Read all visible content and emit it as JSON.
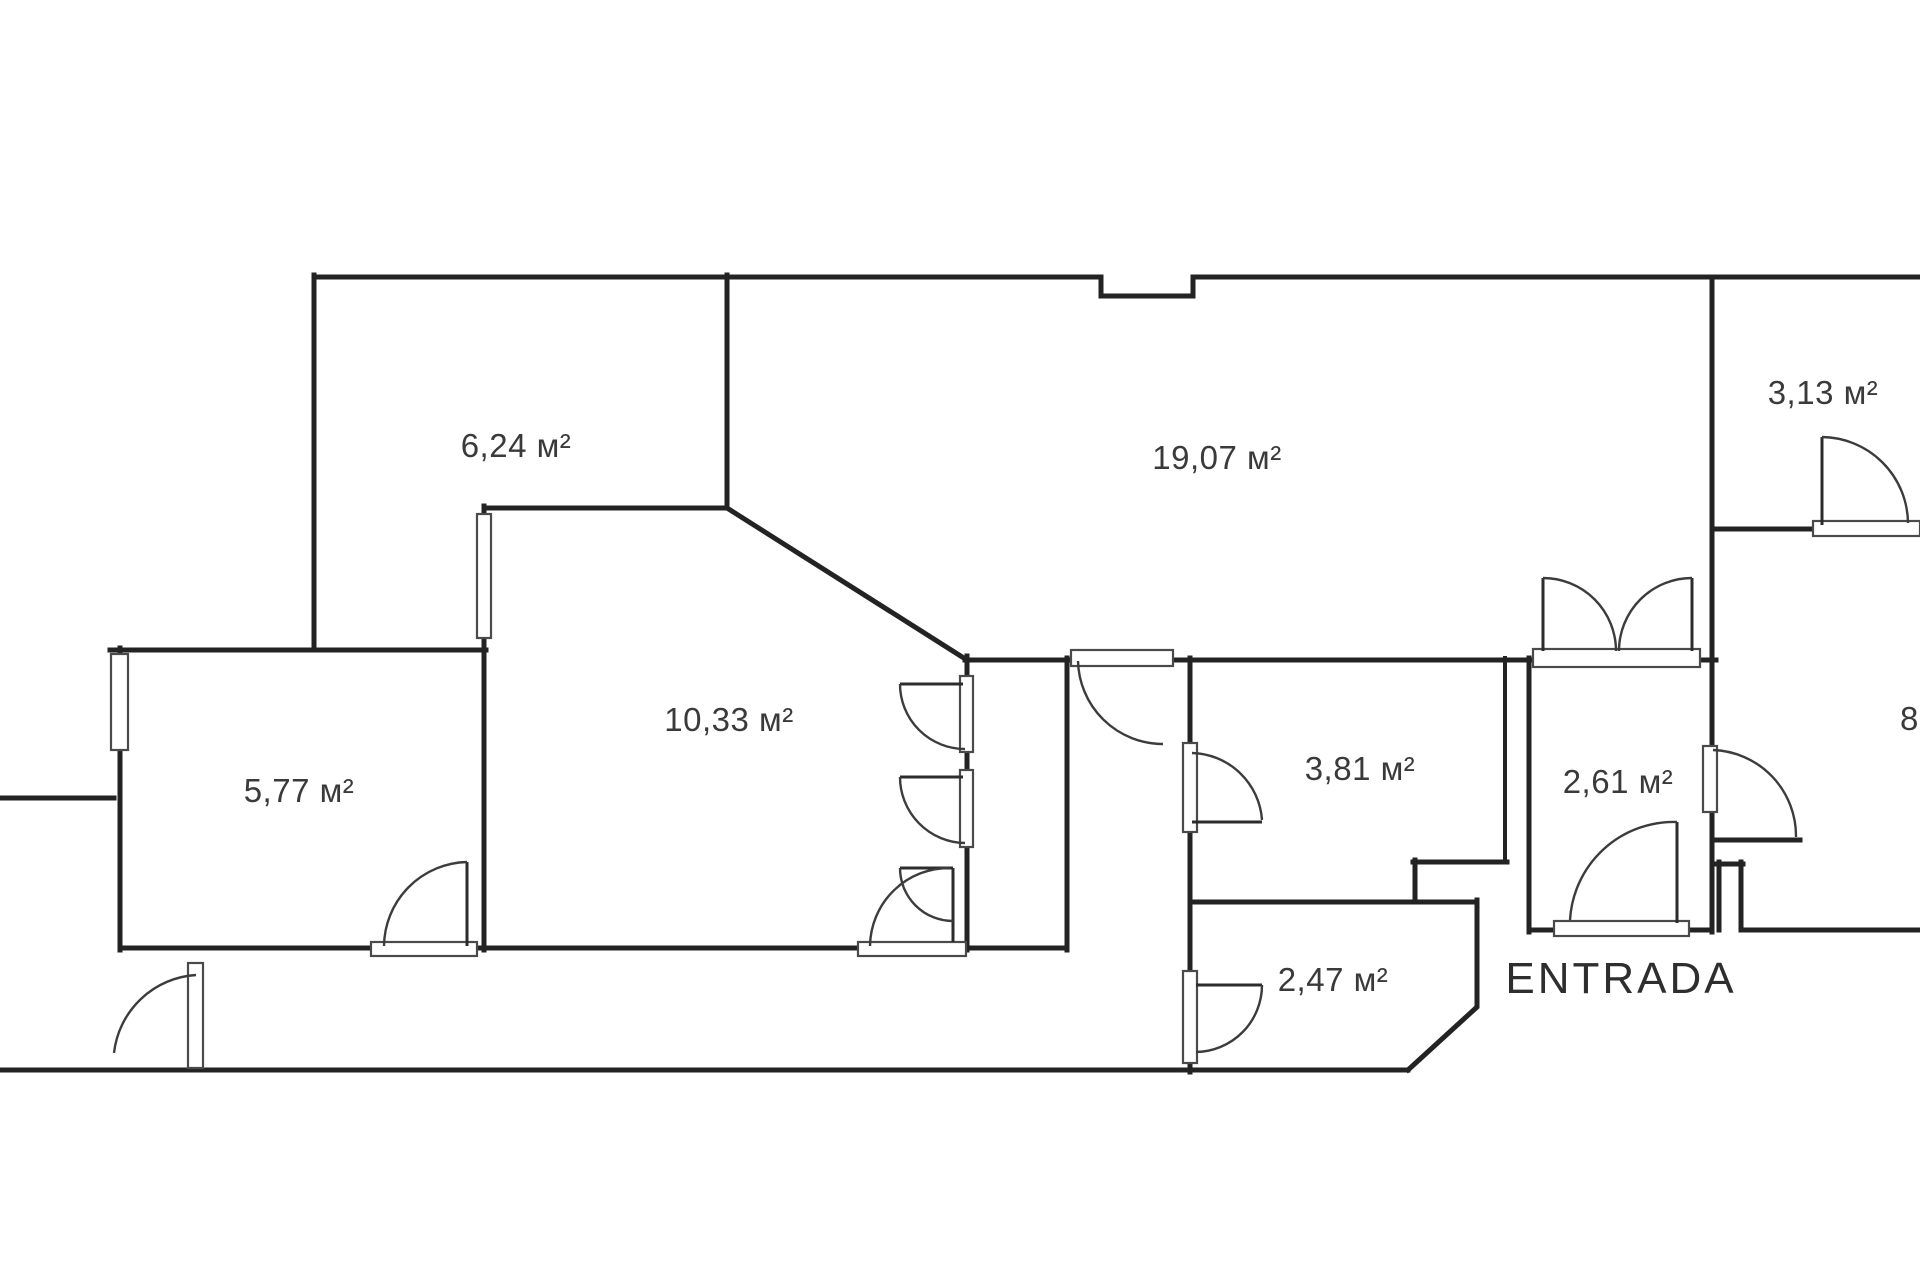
{
  "drawing_type": "apartment floor plan",
  "room_labels": {
    "r_6_24": "6,24 м²",
    "r_19_07": "19,07 м²",
    "r_3_13": "3,13 м²",
    "r_10_33": "10,33 м²",
    "r_5_77": "5,77 м²",
    "r_3_81": "3,81 м²",
    "r_2_61": "2,61 м²",
    "r_2_47": "2,47 м²"
  },
  "entrance_label": "ENTRADA",
  "partial_labels": {
    "right_edge": "8,",
    "left_edge": "²"
  },
  "colors": {
    "background": "#ffffff",
    "walls": "#232323",
    "door_arcs": "#3c3c3c",
    "labels": "#3a3a3a",
    "entrance_text": "#2e2e2e",
    "sill_outline": "#4a4a4a"
  }
}
